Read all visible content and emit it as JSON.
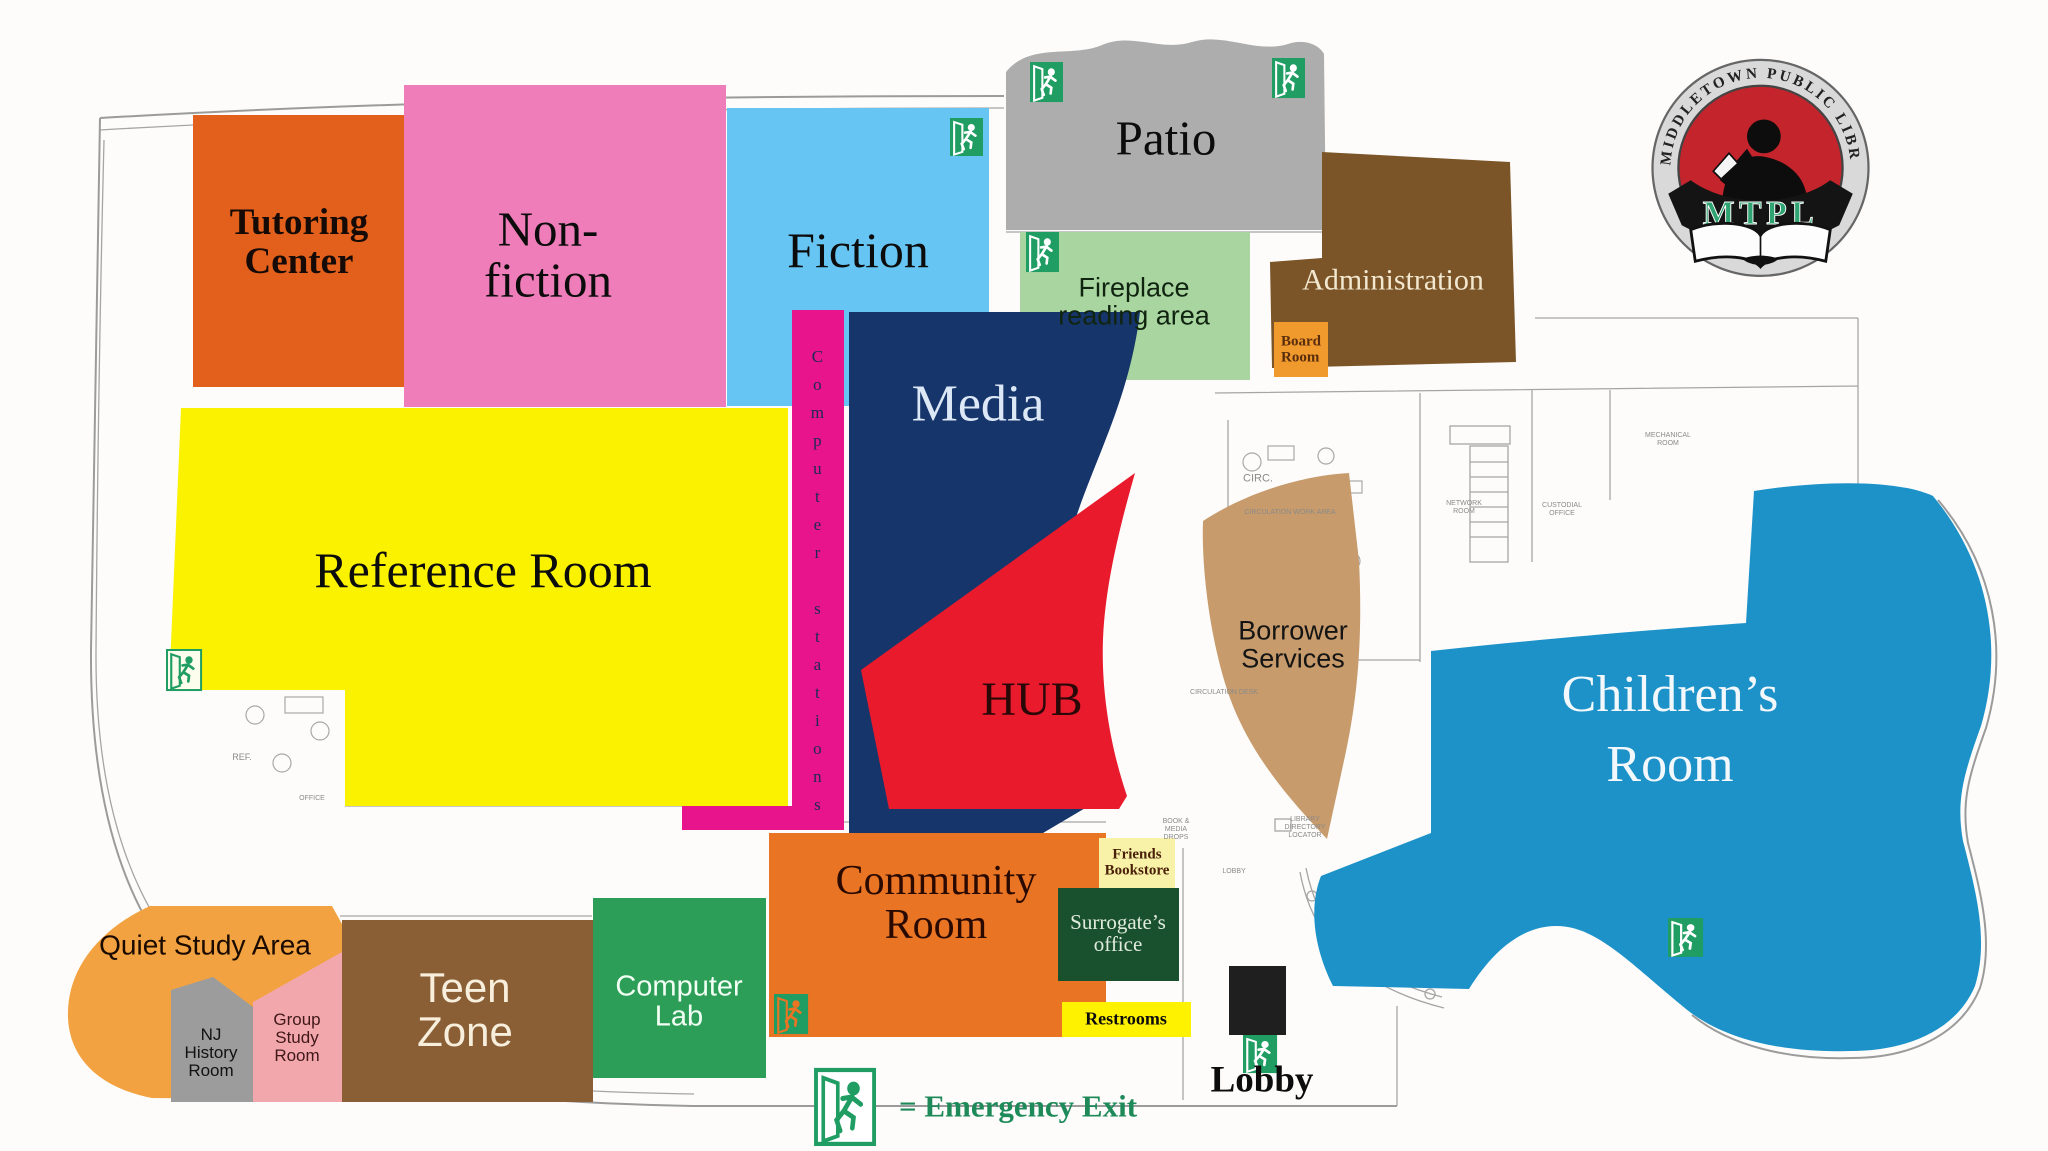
{
  "title": "Middletown Public Library floor plan",
  "logo": {
    "ring_text": "MIDDLETOWN   PUBLIC   LIBRARY",
    "acronym": "MTPL"
  },
  "legend": {
    "emergency_exit_label": "= Emergency Exit"
  },
  "rooms": {
    "tutoring": {
      "label": "Tutoring\nCenter"
    },
    "nonfiction": {
      "label": "Non-\nfiction"
    },
    "fiction": {
      "label": "Fiction"
    },
    "patio": {
      "label": "Patio"
    },
    "fireplace": {
      "label": "Fireplace\nreading area"
    },
    "administration": {
      "label": "Administration"
    },
    "board_room": {
      "label": "Board\nRoom"
    },
    "reference": {
      "label": "Reference Room"
    },
    "computer_stations": {
      "label": "Computer stations"
    },
    "media": {
      "label": "Media"
    },
    "hub": {
      "label": "HUB"
    },
    "borrower": {
      "label": "Borrower\nServices"
    },
    "children": {
      "label": "Children’s\nRoom"
    },
    "quiet_study": {
      "label": "Quiet Study Area"
    },
    "nj_history": {
      "label": "NJ\nHistory\nRoom"
    },
    "group_study": {
      "label": "Group\nStudy\nRoom"
    },
    "teen_zone": {
      "label": "Teen\nZone"
    },
    "computer_lab": {
      "label": "Computer\nLab"
    },
    "community": {
      "label": "Community\nRoom"
    },
    "friends": {
      "label": "Friends\nBookstore"
    },
    "surrogate": {
      "label": "Surrogate’s\noffice"
    },
    "restrooms": {
      "label": "Restrooms"
    },
    "lobby": {
      "label": "Lobby"
    }
  },
  "floorplan_labels": {
    "ref": "REF.",
    "office": "OFFICE",
    "circ": "CIRC.",
    "circ_work": "CIRCULATION WORK AREA",
    "circ_desk": "CIRCULATION DESK",
    "network": "NETWORK\nROOM",
    "custodial": "CUSTODIAL\nOFFICE",
    "mechanical": "MECHANICAL\nROOM",
    "drops": "BOOK &\nMEDIA\nDROPS",
    "directory": "LIBRARY\nDIRECTORY\nLOCATOR",
    "lobby_small": "LOBBY"
  },
  "colors": {
    "tutoring": "#E2601C",
    "nonfiction": "#EF7DB9",
    "fiction": "#66C5F2",
    "patio": "#ADADAD",
    "fireplace": "#A9D6A0",
    "administration": "#7B5427",
    "board": "#F09A2E",
    "reference": "#FBF200",
    "stations": "#E8148C",
    "media": "#16356B",
    "hub": "#E81A2C",
    "borrower": "#C79B6B",
    "children": "#1D92C8",
    "quiet": "#F2A240",
    "njhistory": "#9C9C9C",
    "group": "#F2A7AD",
    "teen": "#8A5F36",
    "lab": "#2C9E57",
    "community": "#E87424",
    "friends": "#F7F2A8",
    "surrogate": "#19512F",
    "restrooms": "#FFF200",
    "exit_green": "#1F9D63",
    "legend_text": "#1E8A5A",
    "logo_red": "#C4242B",
    "logo_green": "#2FA371"
  }
}
